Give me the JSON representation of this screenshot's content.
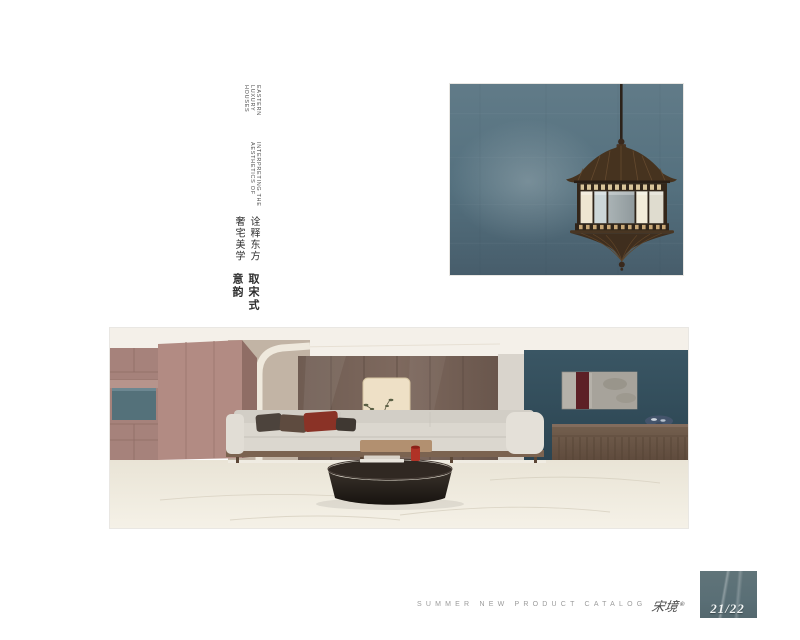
{
  "header": {
    "en_line1": "EASTERN LUXURY HOUSES",
    "en_line2": "INTERPRETING THE AESTHETICS OF",
    "cn_sub": "诠释东方奢宅美学",
    "cn_main": "取宋式意韵"
  },
  "footer": {
    "catalog_label": "SUMMER NEW PRODUCT CATALOG",
    "brand_logo": "宋境",
    "brand_mark": "®",
    "page_number": "21/22"
  },
  "palette": {
    "page_bg": "#ffffff",
    "lantern_wall": "#54707e",
    "accent_wall": "#32505d",
    "wood_cabinet": "#ac8781",
    "teal_inset": "#54717a",
    "sideboard_brown": "#6a5546",
    "floor_cream": "#efeade",
    "swatch_blue_gray": "#5a6f76",
    "footer_text_gray": "#9b9b9b",
    "maroon_accent": "#8a3226"
  }
}
